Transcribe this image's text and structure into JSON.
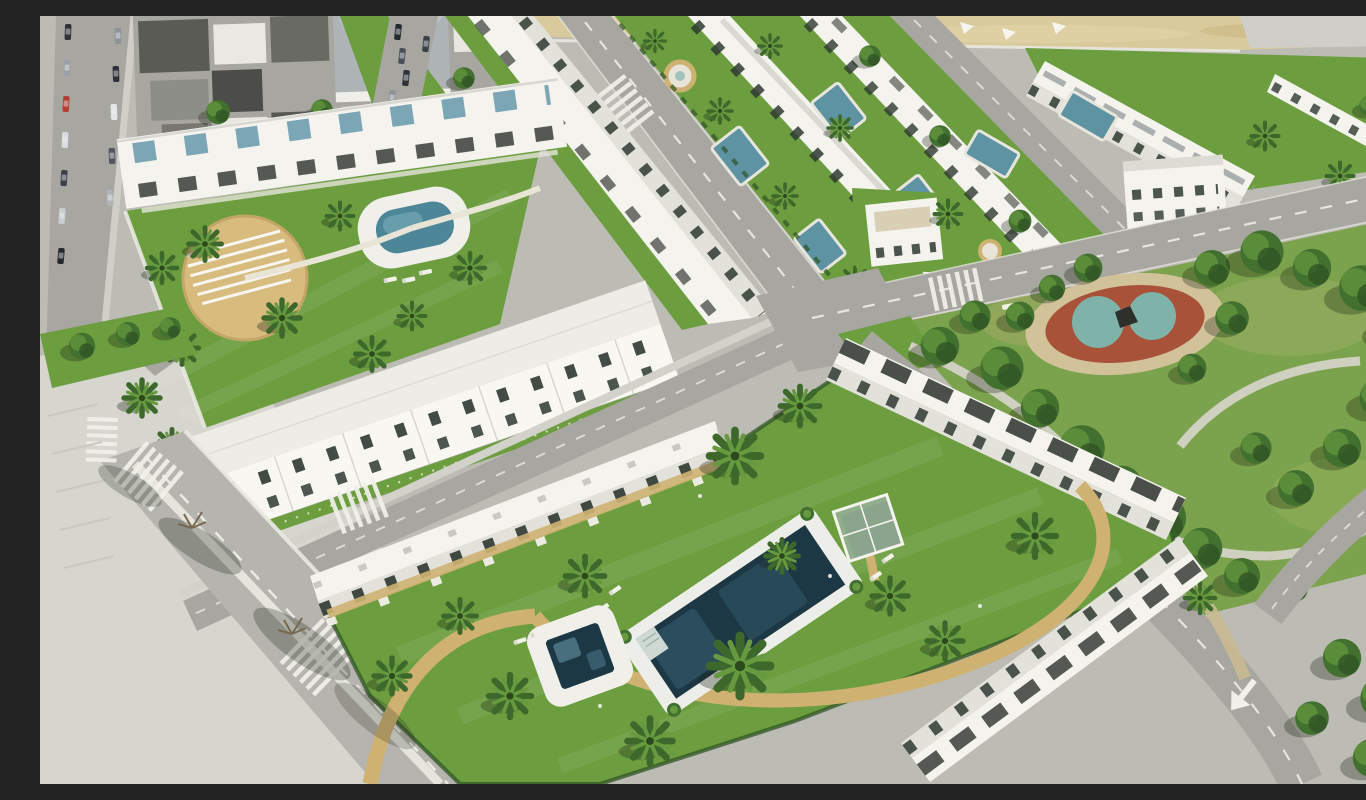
{
  "scene": {
    "description": "High-angle aerial 3D architectural render of a coastal residential development: rows of white Mediterranean apartment blocks and townhouses around communal lawns with swimming pools and palm trees, an existing town with parked cars at the top left, linear garden strips with plunge pools between terraced rows at the top, a sandy beach strip along the top right, a dense pine park with an oval red-and-teal playground on the right, and grey asphalt roads with zebra crossings, dashed lane lines and a white directional arrow at the bottom right.",
    "view": "oblique aerial",
    "time_of_day": "daytime"
  },
  "palette": {
    "road": "#a7a6a0",
    "road_light": "#bcbbb4",
    "pavement": "#d6d5ce",
    "lane": "#f1f0ea",
    "grass": "#6c9e3f",
    "grass_dark": "#557f2f",
    "grass_light": "#85ab52",
    "park_grass": "#7ba24c",
    "tree_dark": "#2f5424",
    "tree_mid": "#41702f",
    "tree_light": "#5f913c",
    "palm_dark": "#3c682b",
    "palm_light": "#67993e",
    "bld_white": "#f4f3ee",
    "bld_shade": "#e2e1da",
    "bld_grey": "#aeb3b5",
    "roof_dark": "#55554f",
    "pergola": "#393d37",
    "window": "#2e3831",
    "teal_roof": "#6fa0b0",
    "pool_deep": "#1d3845",
    "pool_mid": "#2f5363",
    "pool_light": "#5d93a3",
    "sand": "#d9ca9c",
    "path_tan": "#cfb272",
    "plaza_tan": "#d7bc7e",
    "pg_red": "#a8523a",
    "pg_teal": "#7fb2a8",
    "car_dark": "#2e3238",
    "shadow": "rgba(30,38,24,0.3)"
  },
  "elements": {
    "pools": [
      "main-rectangular-pool",
      "square-plunge-pool",
      "kidney-pool",
      "garden-strip-pools",
      "villa-pools"
    ],
    "vegetation": [
      "palm-trees",
      "pine-park-trees",
      "hedges",
      "lawns"
    ],
    "infrastructure": [
      "roads",
      "zebra-crossings",
      "lane-markings",
      "road-arrow",
      "parked-cars",
      "playground",
      "beach-strip",
      "glass-gazebo",
      "sun-loungers"
    ]
  }
}
